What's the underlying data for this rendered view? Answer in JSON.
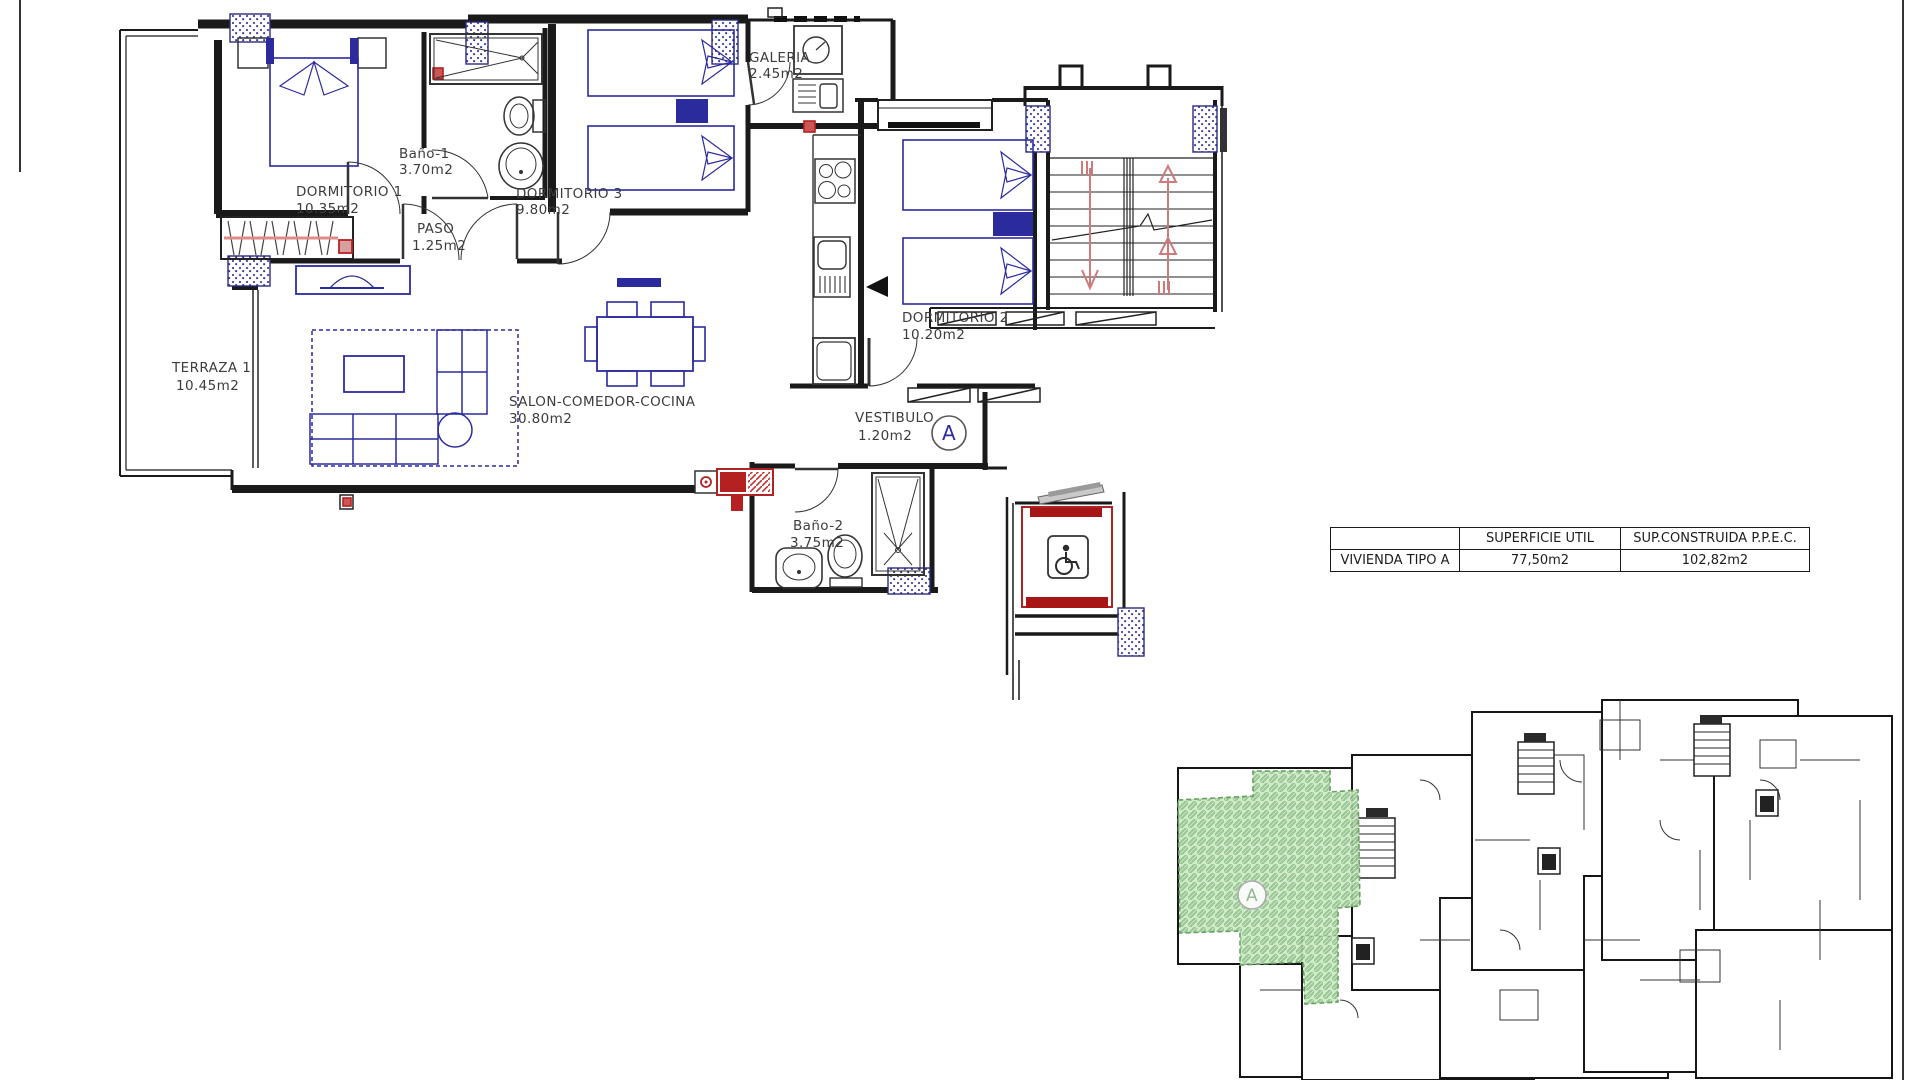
{
  "plan": {
    "rooms": [
      {
        "name": "DORMITORIO 1",
        "area": "10.35m2"
      },
      {
        "name": "Baño-1",
        "area": "3.70m2"
      },
      {
        "name": "PASO",
        "area": "1.25m2"
      },
      {
        "name": "DORMITORIO 3",
        "area": "9.80m2"
      },
      {
        "name": "GALERIA",
        "area": "2.45m2"
      },
      {
        "name": "DORMITORIO 2",
        "area": "10.20m2"
      },
      {
        "name": "TERRAZA 1",
        "area": "10.45m2"
      },
      {
        "name": "SALON-COMEDOR-COCINA",
        "area": "30.80m2"
      },
      {
        "name": "VESTIBULO",
        "area": "1.20m2"
      },
      {
        "name": "Baño-2",
        "area": "3.75m2"
      }
    ],
    "unit_marker": "A"
  },
  "summary_table": {
    "col_superficie": "SUPERFICIE UTIL",
    "col_construida": "SUP.CONSTRUIDA P.P.E.C.",
    "row_label": "VIVIENDA TIPO A",
    "superficie_util": "77,50m2",
    "sup_construida": "102,82m2"
  },
  "key_plan": {
    "unit_marker": "A"
  },
  "icons": {
    "wheelchair_icon": "♿"
  },
  "colors": {
    "wall": "#1a1a1a",
    "furniture_blue": "#2b2b9e",
    "accent_red": "#bb2222",
    "stair_arrow": "#cc7a7a",
    "highlight_green": "#cdeac6",
    "hatch_green": "#8fc08a"
  }
}
